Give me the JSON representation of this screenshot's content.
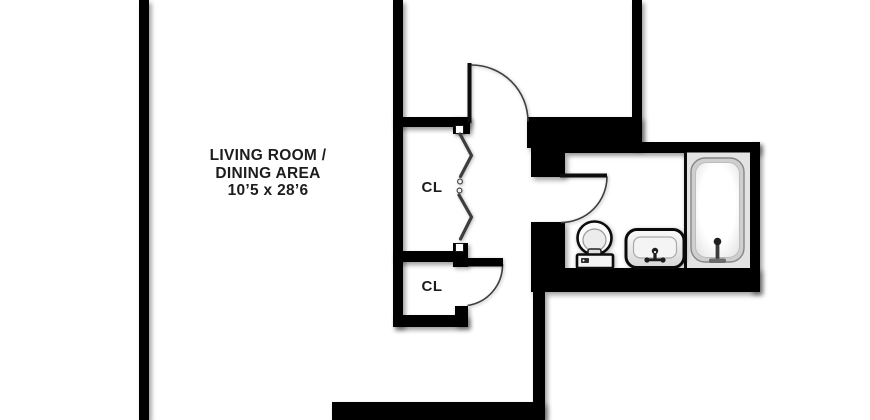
{
  "floorplan": {
    "rooms": {
      "living_room": {
        "name_line1": "LIVING ROOM /",
        "name_line2": "DINING AREA",
        "dimensions": "10’5 x 28’6"
      },
      "closet_top": {
        "label": "CL"
      },
      "closet_bottom": {
        "label": "CL"
      }
    },
    "fixtures": [
      "toilet",
      "sink",
      "bathtub"
    ],
    "doors": {
      "hinged_doors": 3,
      "bifold_closet_doors": 2
    },
    "colors": {
      "wall": "#000000",
      "floor": "#ffffff",
      "text": "#1d1d1d",
      "tub_alcove": "#e3e3e3"
    }
  }
}
